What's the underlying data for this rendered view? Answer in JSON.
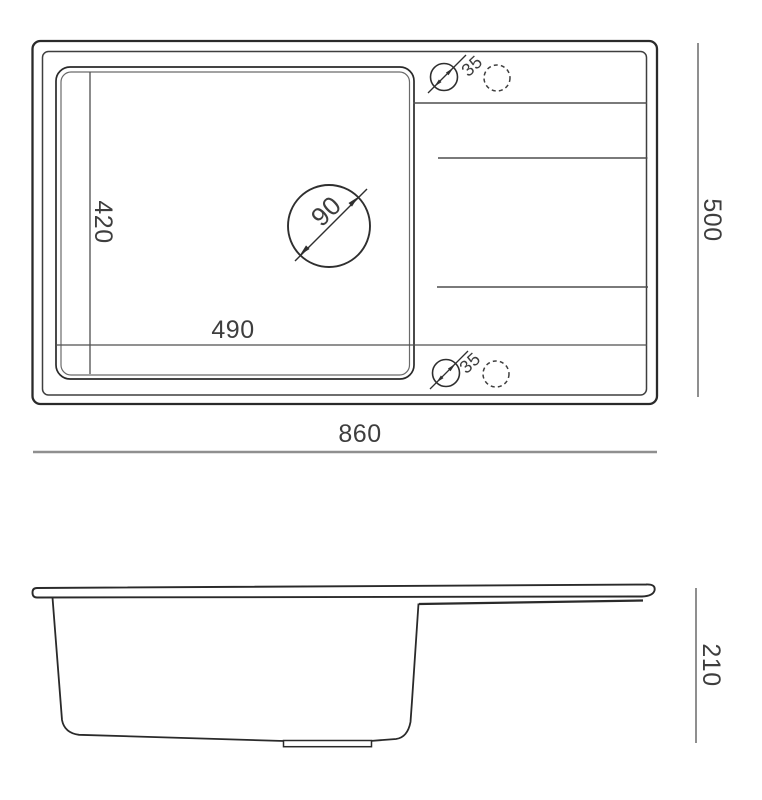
{
  "title": "Kitchen sink technical drawing with dimensions",
  "colors": {
    "outline": "#2a2a2a",
    "secondary_line": "#4f4f4f",
    "light_line": "#6a6a6a",
    "dimension_line": "#8f8f8f",
    "text": "#3e3e3e",
    "background": "#ffffff"
  },
  "dimensions": {
    "overall_width": "860",
    "overall_depth": "500",
    "bowl_width": "490",
    "bowl_depth": "420",
    "drain_diameter": "90",
    "tap_hole_diameter_top": "35",
    "tap_hole_diameter_bottom": "35",
    "side_height": "210"
  }
}
